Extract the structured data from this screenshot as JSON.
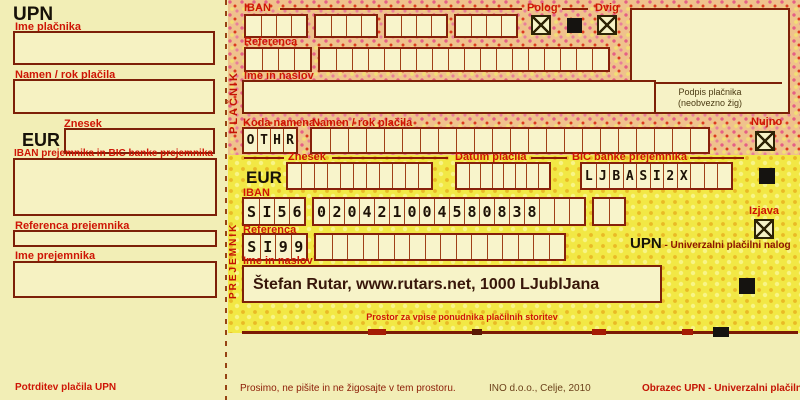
{
  "talon": {
    "title": "UPN",
    "payer_name_label": "Ime plačnika",
    "purpose_label": "Namen / rok plačila",
    "amount_label": "Znesek",
    "currency": "EUR",
    "recipient_iban_bic_label": "IBAN prejemnika in BIC banke prejemnika",
    "recipient_reference_label": "Referenca prejemnika",
    "recipient_name_label": "Ime prejemnika",
    "confirmation_label": "Potrditev plačila UPN"
  },
  "form": {
    "payer_vertical_label": "PLAČNIK",
    "recipient_vertical_label": "PREJEMNIK",
    "iban_label": "IBAN",
    "deposit_label": "Polog",
    "withdrawal_label": "Dvig",
    "reference_label": "Referenca",
    "name_address_label": "Ime in naslov",
    "signature_line1": "Podpis plačnika",
    "signature_line2": "(neobvezno žig)",
    "purpose_code_label": "Koda namena",
    "purpose_label": "Namen / rok plačila",
    "urgent_label": "Nujno",
    "amount_label": "Znesek",
    "currency": "EUR",
    "payment_date_label": "Datum plačila",
    "recipient_bic_label": "BIC banke prejemnika",
    "declaration_label": "Izjava",
    "recipient_iban_label": "IBAN",
    "recipient_reference_label": "Referenca",
    "upn_title": "UPN",
    "upn_subtitle": " - Univerzalni plačilni nalog",
    "recipient_name_address_label": "Ime in naslov",
    "recipient_name_address_value": "Štefan Rutar, www.rutars.net, 1000 LJublJana",
    "provider_space_label": "Prostor za vpise ponudnika plačilnih storitev"
  },
  "values": {
    "purpose_code": "OTHR",
    "recipient_bic": "LJBASI2X",
    "recipient_iban": "SI56 0204 2100 4580 838",
    "recipient_reference_model": "SI99"
  },
  "cell_rows": {
    "payer_iban": {
      "groups": [
        {
          "n": 4
        },
        {
          "n": 4
        },
        {
          "n": 4
        },
        {
          "n": 4
        }
      ]
    },
    "payer_reference": {
      "groups": [
        {
          "n": 4
        },
        {
          "n": 18
        }
      ]
    },
    "purpose_code": {
      "groups": [
        {
          "n": 4,
          "text": "OTHR"
        }
      ]
    },
    "purpose": {
      "groups": [
        {
          "n": 22
        }
      ]
    },
    "amount": {
      "groups": [
        {
          "n": 11
        }
      ]
    },
    "payment_date": {
      "groups": [
        {
          "n": 8
        }
      ]
    },
    "recipient_bic": {
      "groups": [
        {
          "n": 11,
          "text": "LJBASI2X"
        }
      ]
    },
    "recipient_iban": {
      "groups": [
        {
          "n": 4,
          "text": "SI56"
        },
        {
          "n": 18,
          "text": "020421004580838"
        },
        {
          "n": 2
        }
      ]
    },
    "recipient_reference": {
      "groups": [
        {
          "n": 4,
          "text": "SI99"
        },
        {
          "n": 16
        }
      ]
    }
  },
  "footer": {
    "note": "Prosimo, ne pišite in ne žigosajte v tem prostoru.",
    "publisher": "INO d.o.o., Celje, 2010",
    "form_name": "Obrazec UPN - Univerzalni plačilni nalog"
  },
  "colors": {
    "label_red": "#ce1505",
    "border_dark_red": "#7d2008",
    "talon_bg": "#f2eeb6",
    "pattern_orange_base": "#efc28c",
    "pattern_yellow_base": "#f2e845",
    "cell_fill": "#f8f4cb",
    "ink_black": "#1d1206"
  }
}
